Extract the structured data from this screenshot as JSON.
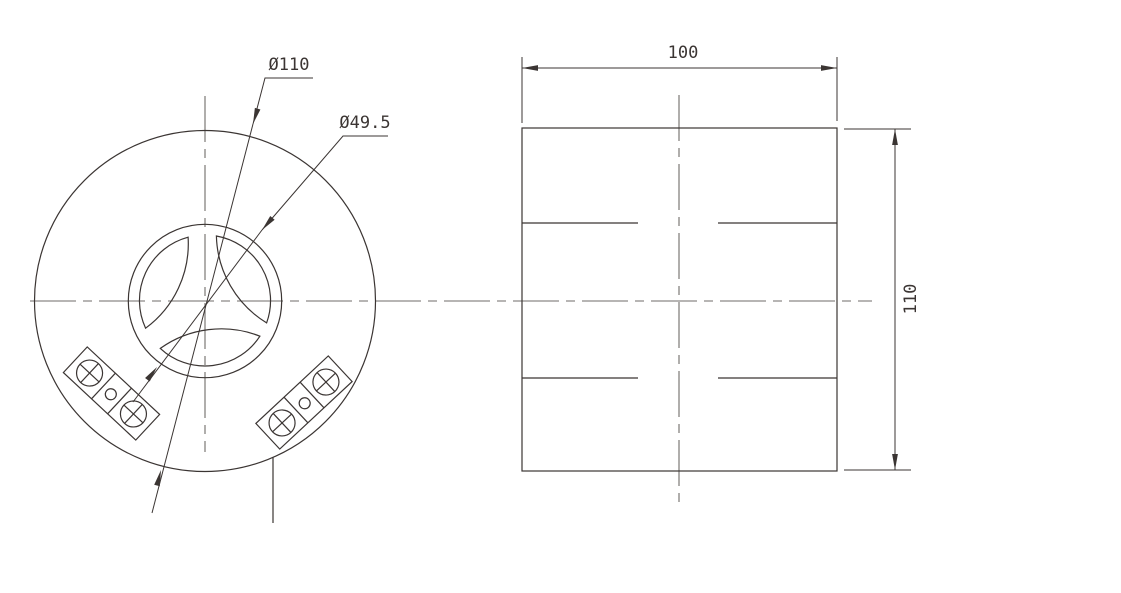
{
  "drawing": {
    "front_view": {
      "outer_diameter_label": "Ø110",
      "inner_diameter_label": "Ø49.5"
    },
    "side_view": {
      "width_label": "100",
      "height_label": "110"
    },
    "colors": {
      "object_line": "#3b3533",
      "centerline": "#6f6b69",
      "background": "#ffffff"
    }
  }
}
